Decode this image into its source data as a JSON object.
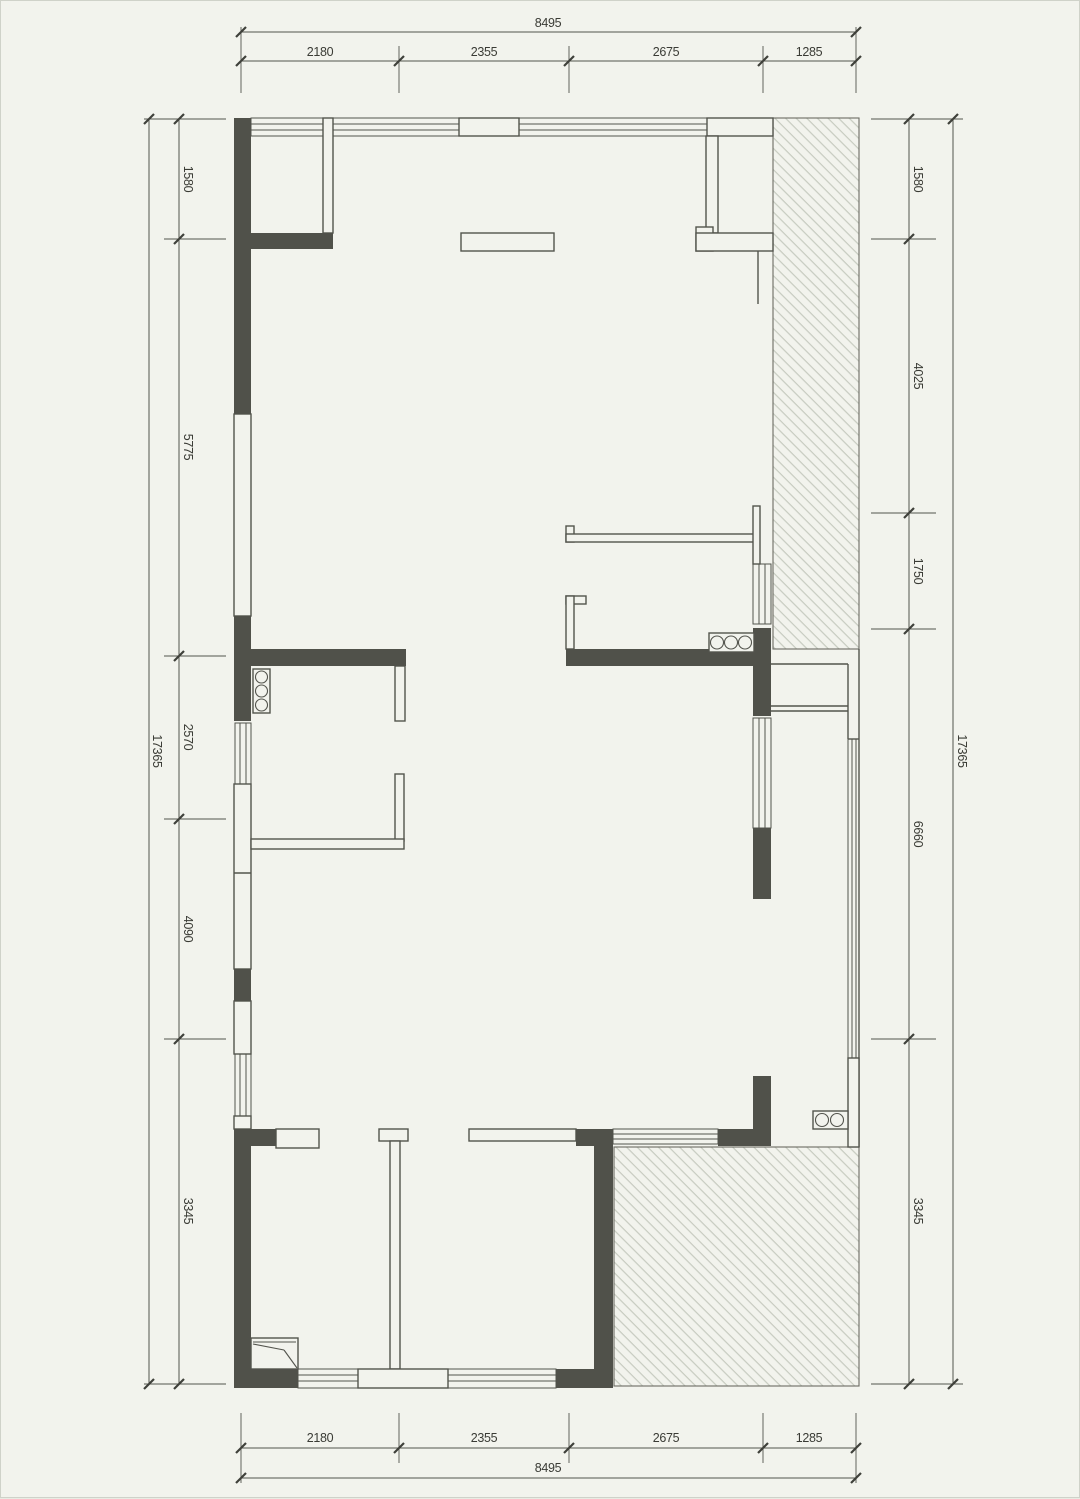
{
  "drawing_title": "floor-plan",
  "colors": {
    "background": "#f2f3ed",
    "wall_dark": "#50514a",
    "line": "#53544d",
    "hatch_line": "#c7cbc0",
    "dim_text": "#3a3b35"
  },
  "dimensions": {
    "top": {
      "total": "8495",
      "segments": [
        "2180",
        "2355",
        "2675",
        "1285"
      ]
    },
    "bottom": {
      "total": "8495",
      "segments": [
        "2180",
        "2355",
        "2675",
        "1285"
      ]
    },
    "left": {
      "total": "17365",
      "segments": [
        "1580",
        "5775",
        "2570",
        "4090",
        "3345"
      ]
    },
    "right": {
      "total": "17365",
      "segments": [
        "1580",
        "4025",
        "1750",
        "6660",
        "3345"
      ]
    }
  },
  "icons": {
    "hob_left": "gas-hob-3-burner-icon",
    "hob_right": "gas-hob-3-burner-icon",
    "sink": "double-basin-sink-icon",
    "shower": "corner-shower-icon"
  }
}
